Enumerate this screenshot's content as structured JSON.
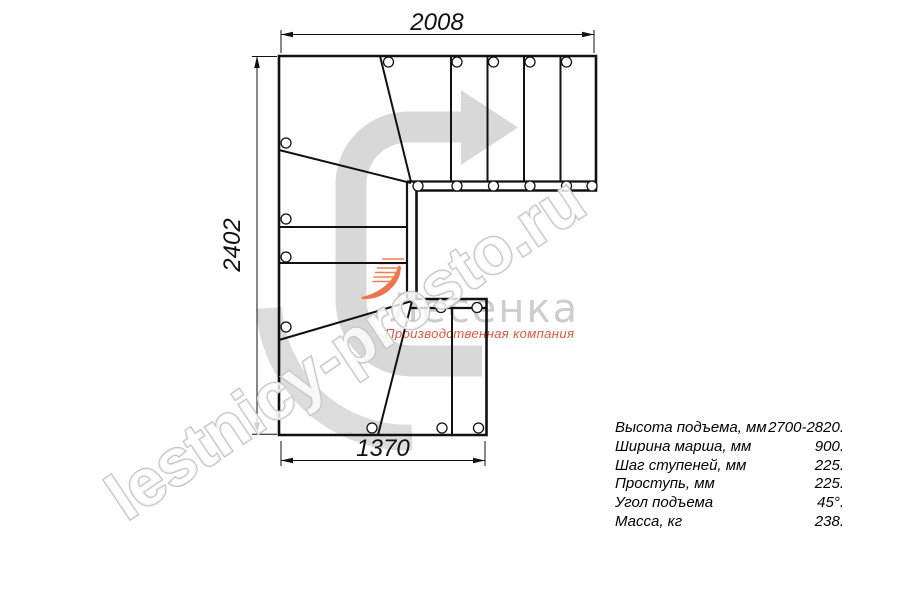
{
  "title": "Staircase plan drawing",
  "dimensions": {
    "width_top_mm": "2008",
    "height_left_mm": "2402",
    "width_bottom_mm": "1370"
  },
  "specs": {
    "rows": [
      {
        "label": "Высота подъема, мм",
        "value": "2700-2820."
      },
      {
        "label": "Ширина марша, мм",
        "value": "900."
      },
      {
        "label": "Шаг ступеней, мм",
        "value": "225."
      },
      {
        "label": "Проступь, мм",
        "value": "225."
      },
      {
        "label": "Угол подъема",
        "value": "45°."
      },
      {
        "label": "Масса, кг",
        "value": "238."
      }
    ]
  },
  "watermark": {
    "site_text": "lestnicy-prosto.ru",
    "logo_name": "Лесенка",
    "logo_tagline": "Производственная компания"
  },
  "colors": {
    "line": "#111111",
    "arrow_gray": "#d8d8d8",
    "ring_gray": "#dcdcdc",
    "watermark_outline": "#c6c6c6",
    "logo_gray": "#c8c8c8",
    "logo_orange": "#ee744a",
    "tagline_red": "#e25844"
  }
}
